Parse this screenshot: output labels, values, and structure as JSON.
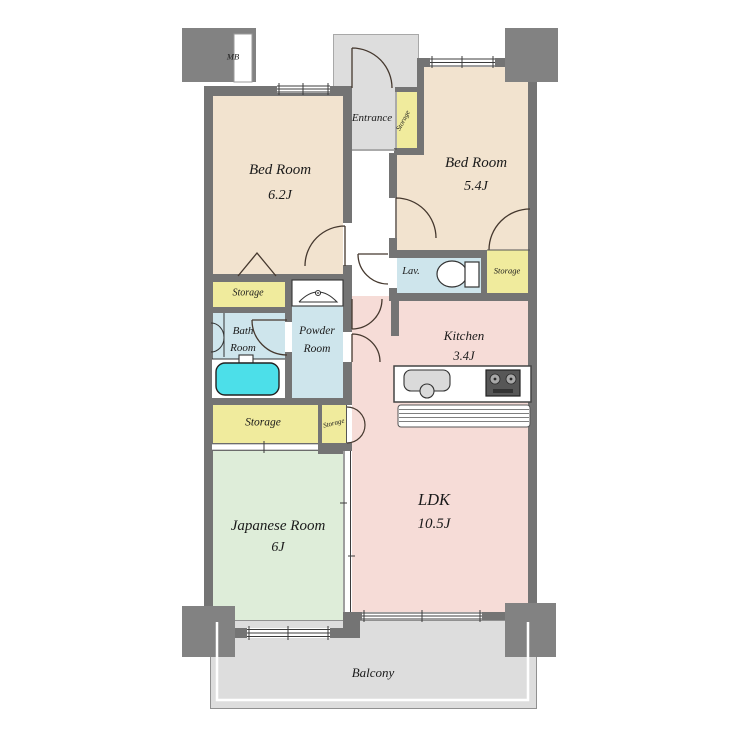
{
  "colors": {
    "wall": "#747474",
    "pillar": "#828282",
    "bedroom": "#f2e3cf",
    "living": "#f6dcd7",
    "japanese": "#deedd9",
    "wet": "#cee5ec",
    "storage": "#f0eb9d",
    "bathtub": "#4cdfe9",
    "outdoor": "#dddddd",
    "text": "#1a1a1a"
  },
  "rooms": {
    "meter_box": {
      "label": "MB"
    },
    "bedroom1": {
      "name": "Bed Room",
      "size": "6.2J"
    },
    "bedroom2": {
      "name": "Bed Room",
      "size": "5.4J"
    },
    "entrance": {
      "name": "Entrance"
    },
    "entrance_storage": {
      "name": "Storage"
    },
    "lavatory": {
      "name": "Lav."
    },
    "lavatory_storage": {
      "name": "Storage"
    },
    "kitchen": {
      "name": "Kitchen",
      "size": "3.4J"
    },
    "bath": {
      "line1": "Bath",
      "line2": "Room"
    },
    "powder": {
      "line1": "Powder",
      "line2": "Room"
    },
    "bath_storage": {
      "name": "Storage"
    },
    "main_storage": {
      "name": "Storage"
    },
    "small_storage": {
      "name": "Storage"
    },
    "japanese_room": {
      "name": "Japanese Room",
      "size": "6J"
    },
    "ldk": {
      "name": "LDK",
      "size": "10.5J"
    },
    "balcony": {
      "name": "Balcony"
    }
  }
}
